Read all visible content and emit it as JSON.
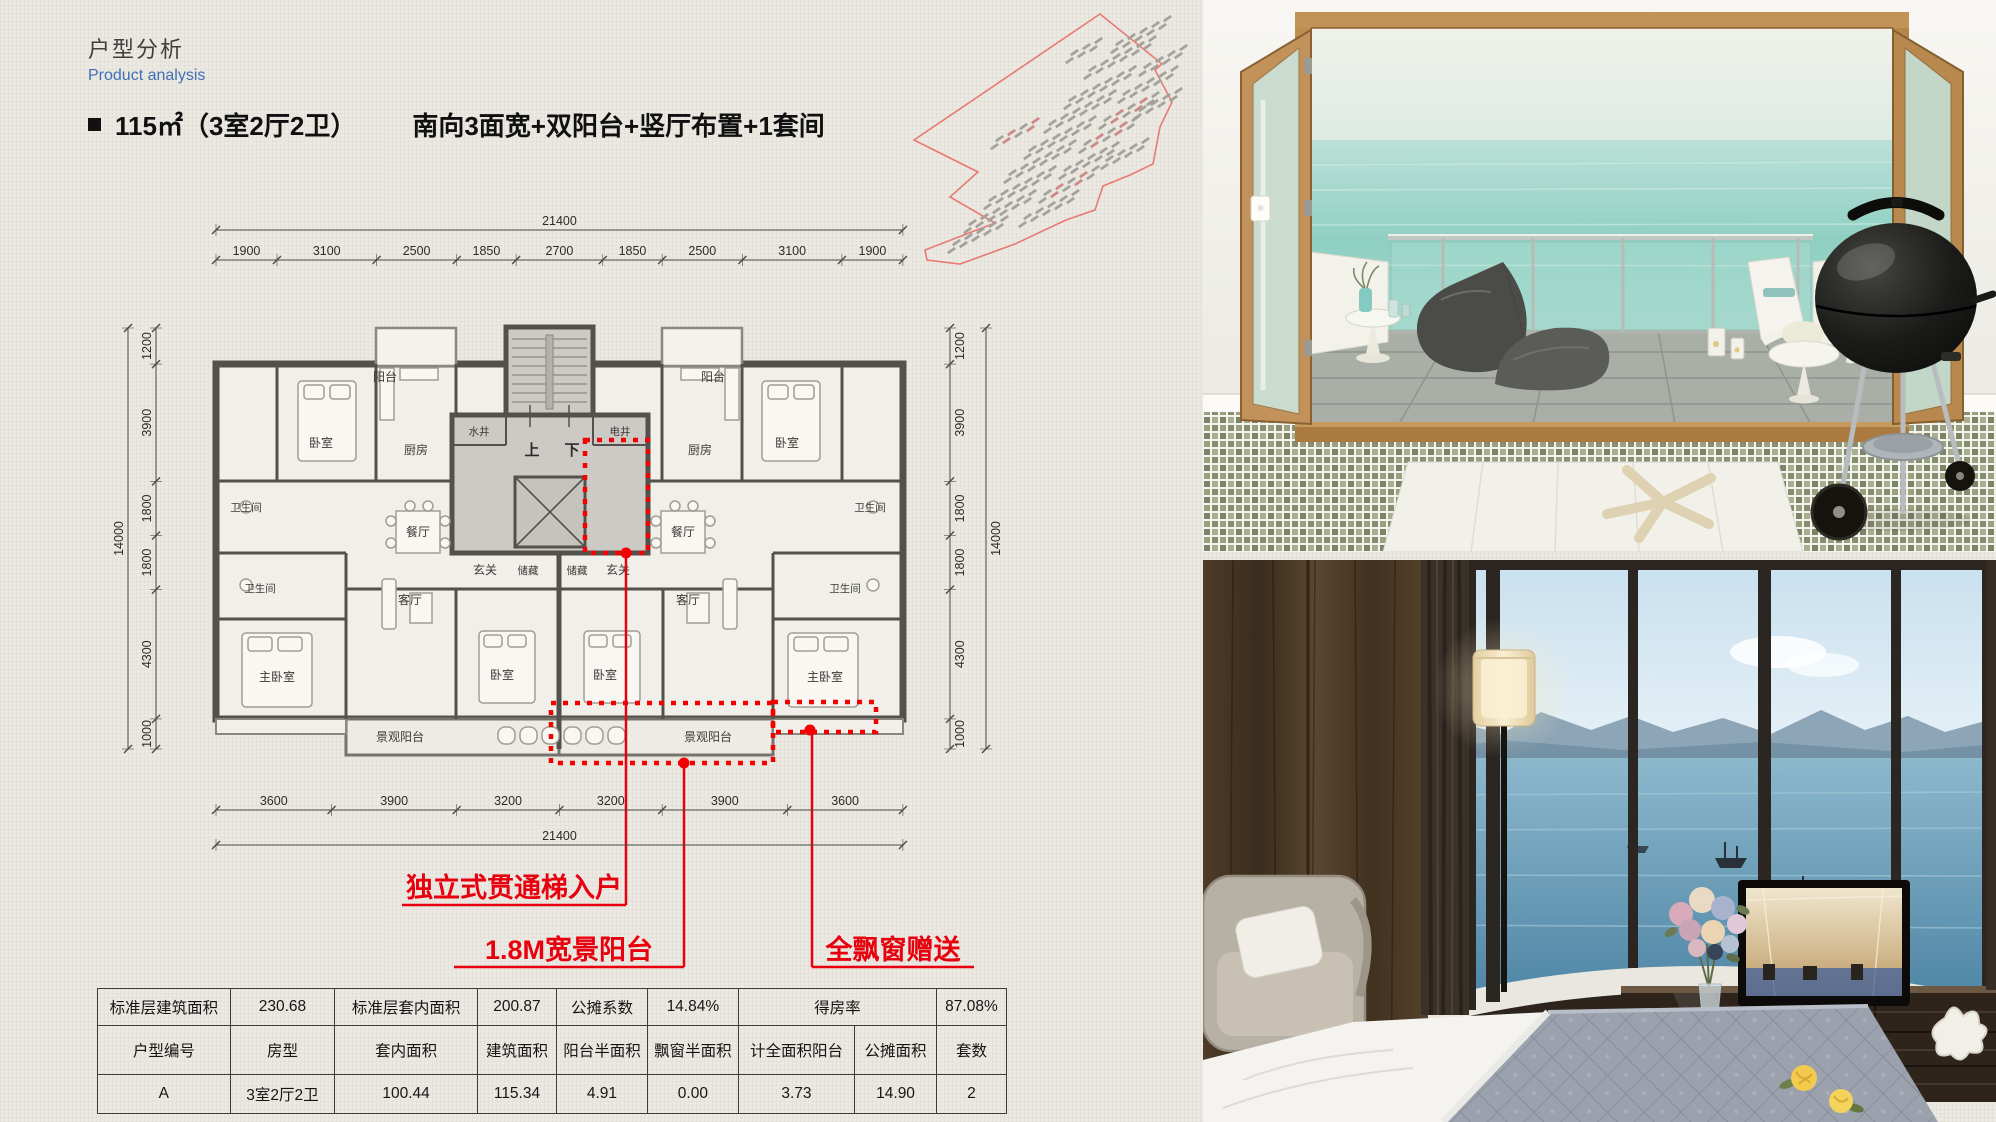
{
  "header": {
    "title_cn": "户型分析",
    "title_en": "Product analysis"
  },
  "headline": {
    "area_spec": "115㎡（3室2厅2卫）",
    "features": "南向3面宽+双阳台+竖厅布置+1套间"
  },
  "floor_plan": {
    "dims": {
      "top_total": "21400",
      "top_segments": [
        "1900",
        "3100",
        "2500",
        "1850",
        "2700",
        "1850",
        "2500",
        "3100",
        "1900"
      ],
      "bottom_total": "21400",
      "bottom_segments": [
        "3600",
        "3900",
        "3200",
        "3200",
        "3900",
        "3600"
      ],
      "left_total": "14000",
      "left_segments": [
        "1200",
        "3900",
        "1800",
        "1800",
        "4300",
        "1000"
      ],
      "right_total": "14000",
      "right_segments": [
        "1200",
        "3900",
        "1800",
        "1800",
        "4300",
        "1000"
      ]
    },
    "rooms": {
      "balcony": "阳台",
      "bedroom": "卧室",
      "master_bedroom": "主卧室",
      "kitchen": "厨房",
      "bathroom": "卫生间",
      "dining": "餐厅",
      "living": "客厅",
      "foyer": "玄关",
      "storage": "储藏",
      "view_balcony": "景观阳台"
    },
    "core": {
      "water_shaft": "水井",
      "electric_shaft": "电井",
      "up": "上",
      "down": "下"
    },
    "annotations": {
      "entry": "独立式贯通梯入户",
      "balcony": "1.8M宽景阳台",
      "bay_window": "全飘窗赠送",
      "color": "#e8000f"
    }
  },
  "table": {
    "r1": [
      "标准层建筑面积",
      "230.68",
      "标准层套内面积",
      "200.87",
      "公摊系数",
      "14.84%",
      "得房率",
      "87.08%"
    ],
    "r2": [
      "户型编号",
      "房型",
      "套内面积",
      "建筑面积",
      "阳台半面积",
      "飘窗半面积",
      "计全面积阳台",
      "公摊面积",
      "套数"
    ],
    "r3": [
      "A",
      "3室2厅2卫",
      "100.44",
      "115.34",
      "4.91",
      "0.00",
      "3.73",
      "14.90",
      "2"
    ]
  }
}
